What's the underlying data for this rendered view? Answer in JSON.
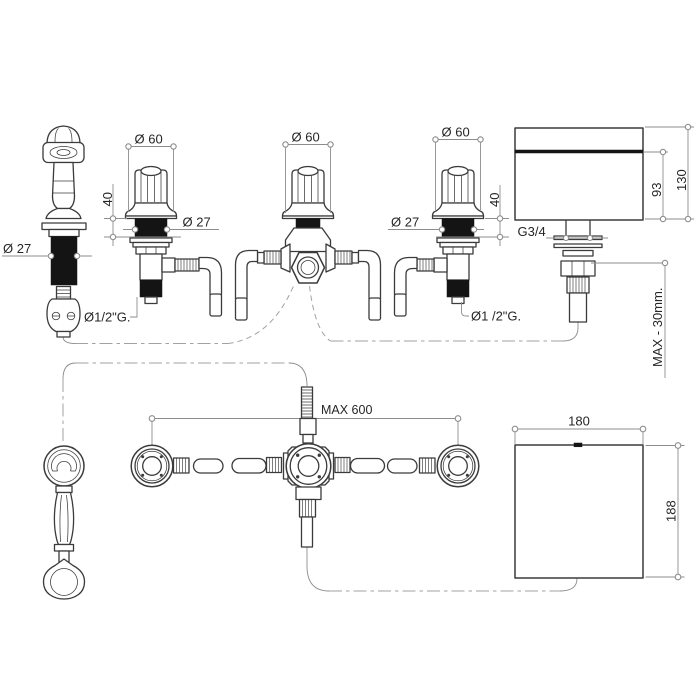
{
  "colors": {
    "paper": "#ffffff",
    "outline": "#3b3b3b",
    "thin_line": "#8d8d8d",
    "dash_line": "#a2a2a2",
    "fill_dark": "#141414",
    "text": "#262626"
  },
  "views": {
    "elevation": {
      "handshower": {
        "shank_diameter": "Ø 27"
      },
      "left_valve": {
        "handle_diameter": "Ø 60",
        "max_deck": "40",
        "shank_diameter": "Ø 27",
        "connection": "Ø1/2\"G."
      },
      "diverter": {
        "handle_diameter": "Ø 60"
      },
      "right_valve": {
        "handle_diameter": "Ø 60",
        "max_deck": "40",
        "shank_diameter": "Ø 27",
        "connection": "Ø1 /2\"G."
      },
      "spout": {
        "connection": "G3/4",
        "body_height": "93",
        "total_height": "130",
        "max_deck": "MAX - 30mm."
      }
    },
    "plan": {
      "max_centres": "MAX 600",
      "spout": {
        "width": "180",
        "depth": "188"
      }
    }
  }
}
